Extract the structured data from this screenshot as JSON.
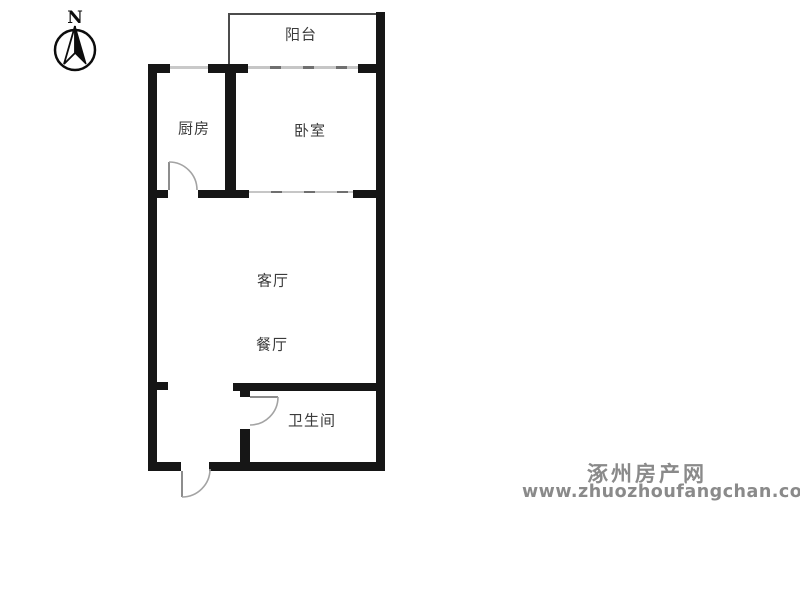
{
  "compass": {
    "label": "N"
  },
  "rooms": {
    "balcony": {
      "label": "阳台"
    },
    "kitchen": {
      "label": "厨房"
    },
    "bedroom": {
      "label": "卧室"
    },
    "living": {
      "label": "客厅"
    },
    "dining": {
      "label": "餐厅"
    },
    "bathroom": {
      "label": "卫生间"
    }
  },
  "watermark": {
    "site_name": "涿州房产网",
    "site_url": "www.zhuozhoufangchan.com"
  },
  "colors": {
    "background": "#ffffff",
    "wall": "#161616",
    "window_line": "#c6c6c6",
    "door_line": "#8d8d8d",
    "label_text": "#3b3b3b",
    "watermark_gray": "#8a8a8a"
  }
}
